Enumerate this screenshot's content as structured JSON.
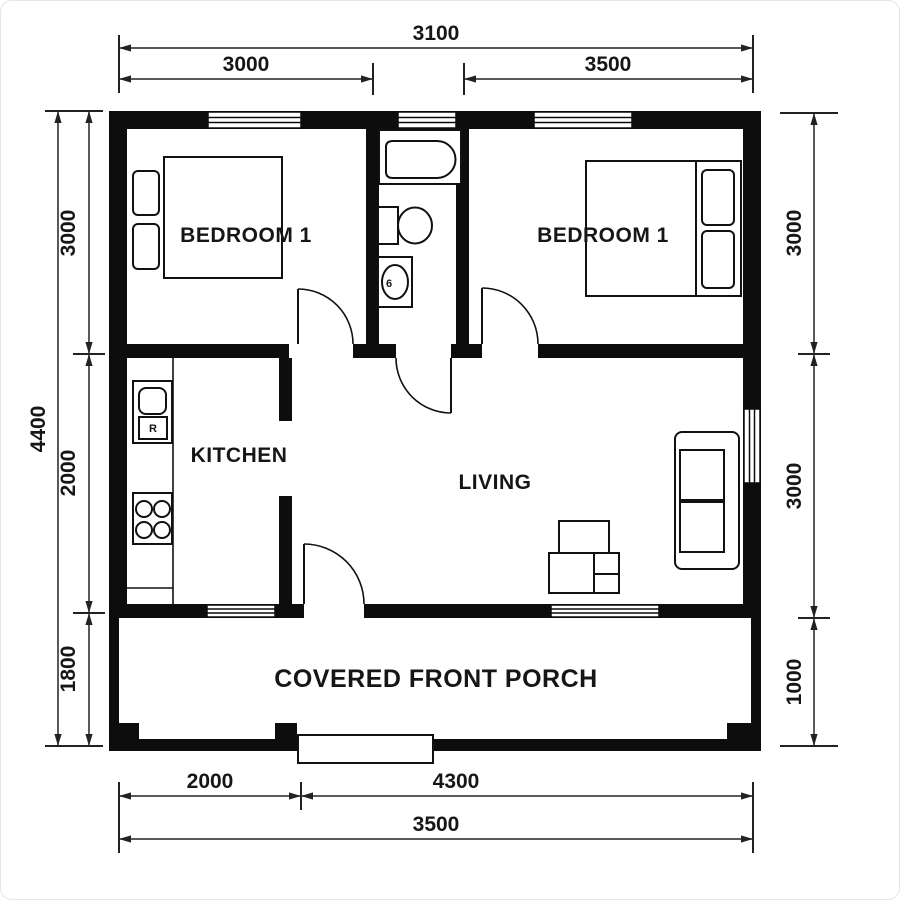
{
  "rooms": {
    "bedroom_left": "BEDROOM 1",
    "bedroom_right": "BEDROOM 1",
    "kitchen": "KITCHEN",
    "living": "LIVING",
    "porch": "COVERED FRONT PORCH"
  },
  "fixtures": {
    "fridge_label": "R",
    "basin_label": "6"
  },
  "dimensions": {
    "top": {
      "overall": "3100",
      "bedroom_left": "3000",
      "bedroom_right": "3500"
    },
    "bottom": {
      "porch_left": "2000",
      "porch_right": "4300",
      "overall": "3500"
    },
    "left": {
      "overall": "4400",
      "upper": "3000",
      "middle": "2000",
      "lower": "1800"
    },
    "right": {
      "upper": "3000",
      "middle": "3000",
      "lower": "1000"
    }
  },
  "colors": {
    "ink": "#0d0d0d",
    "paper": "#ffffff"
  }
}
